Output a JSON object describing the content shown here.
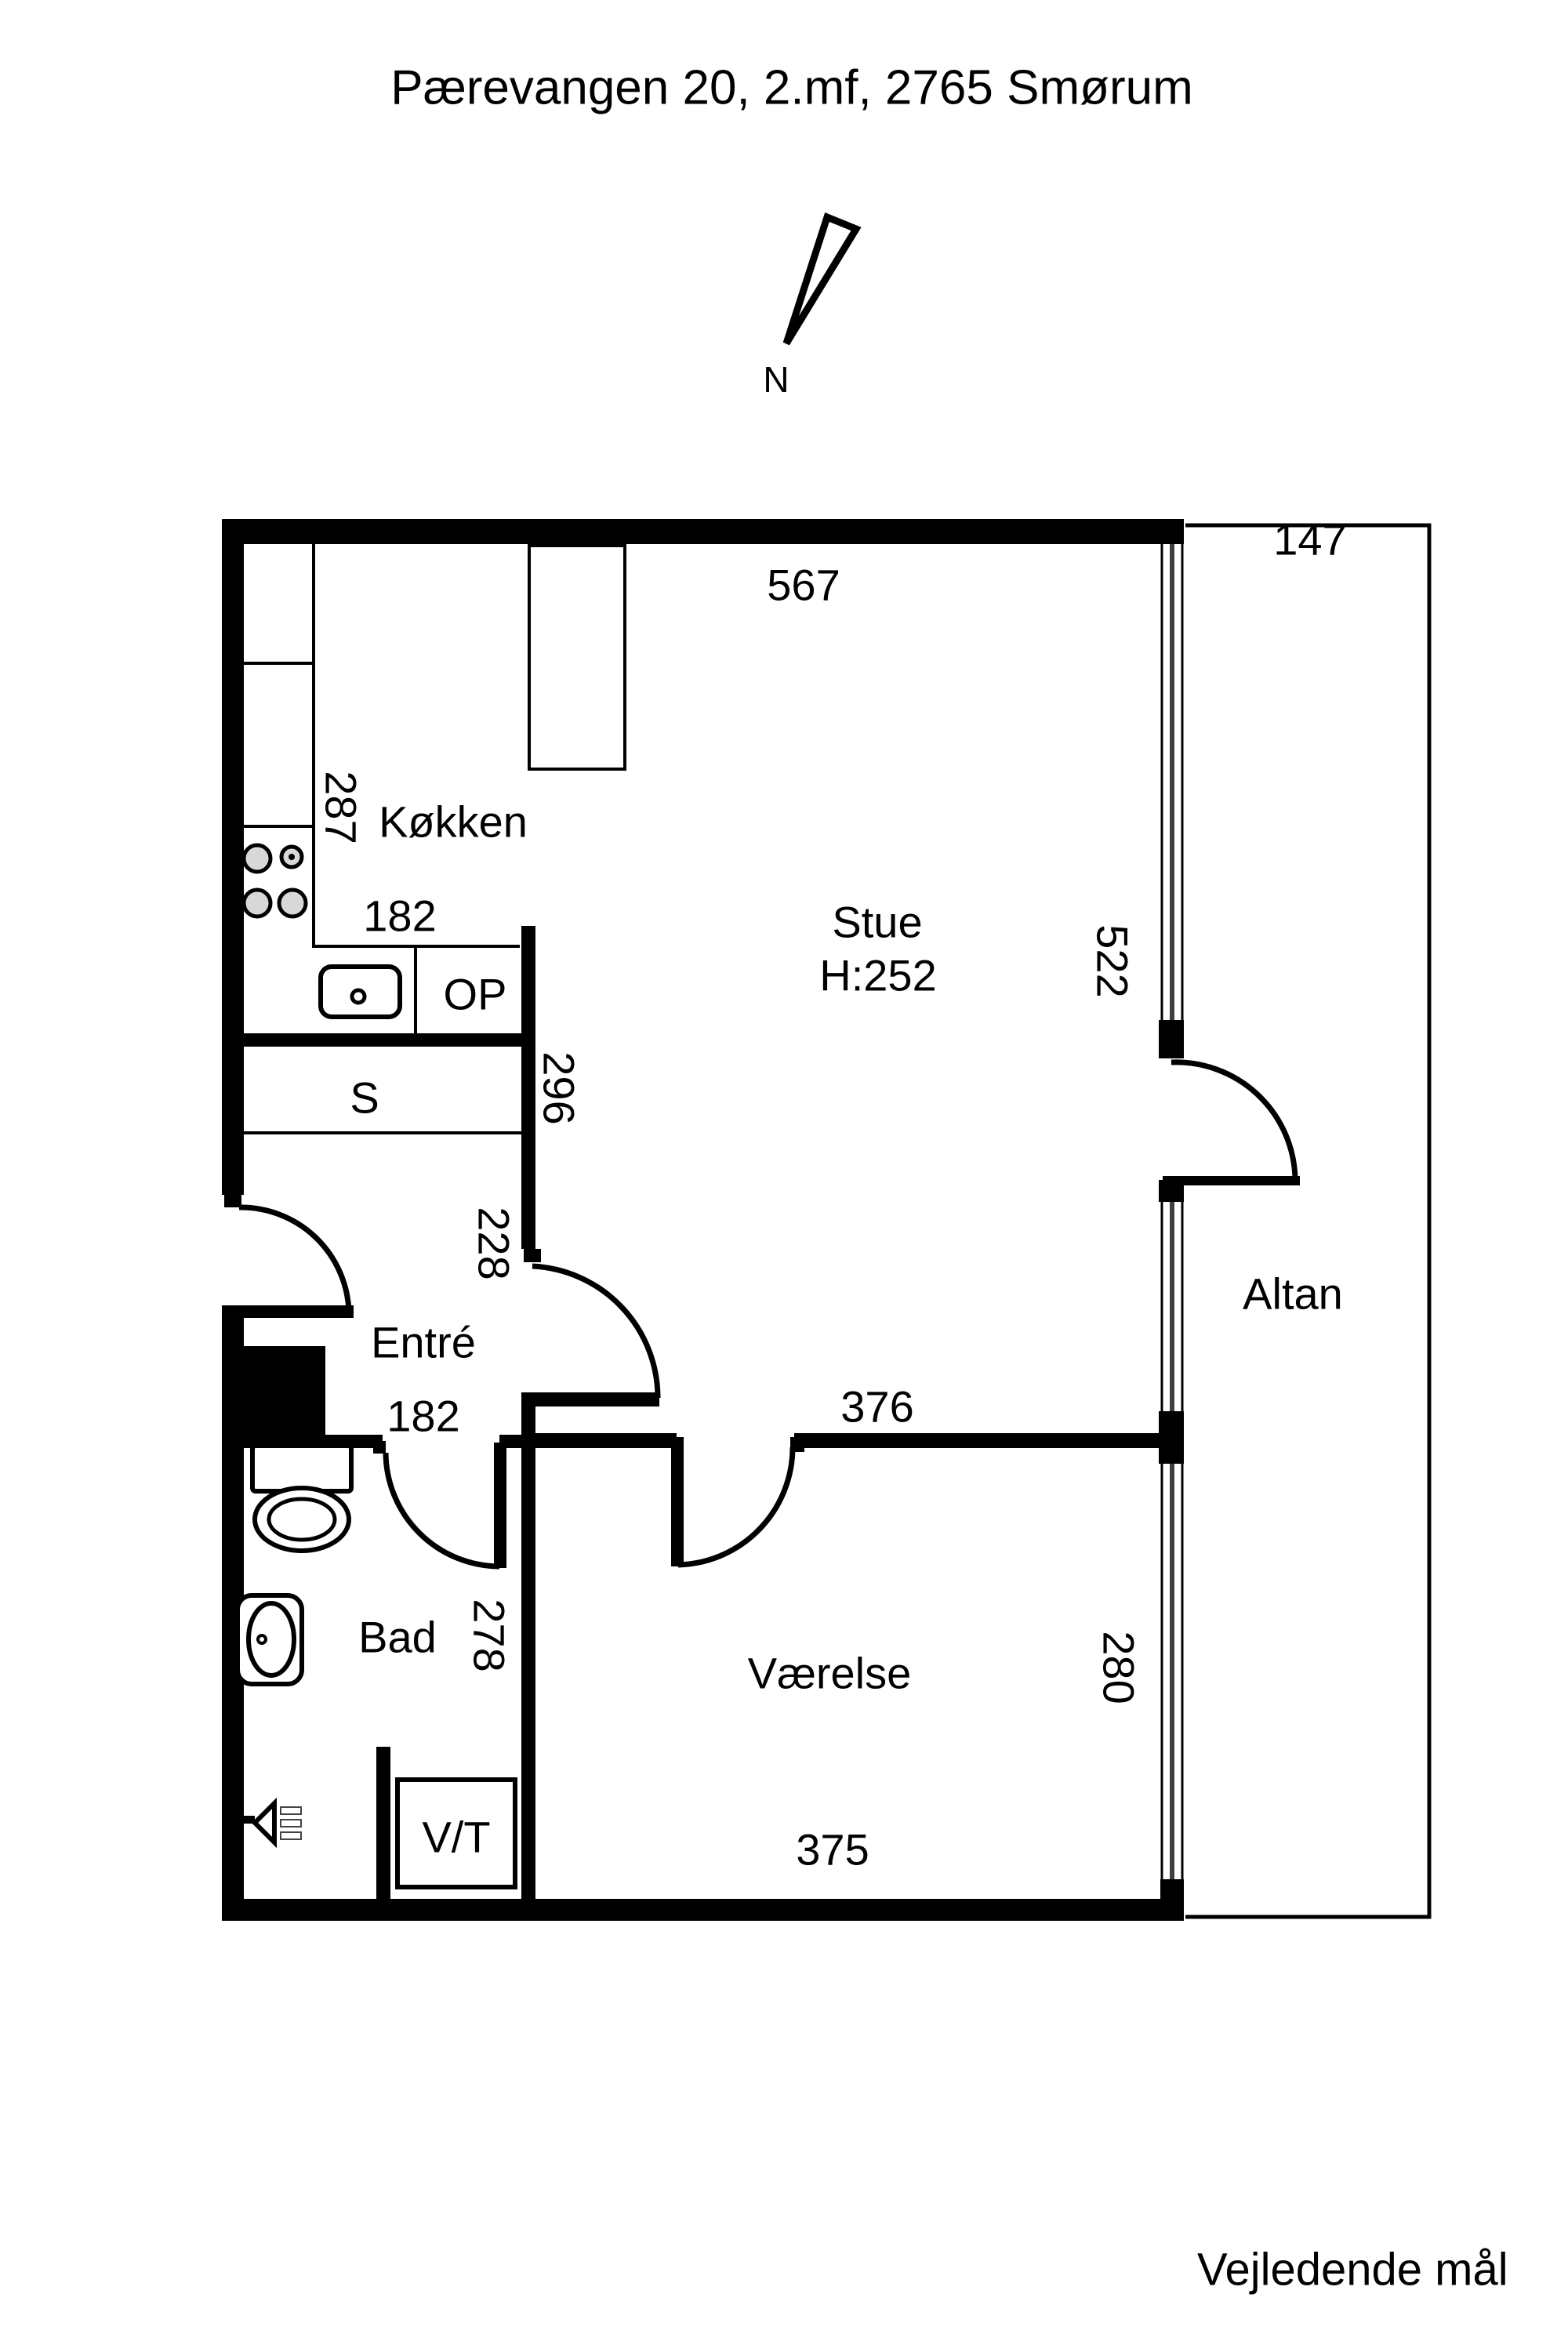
{
  "header": {
    "title": "Pærevangen 20, 2.mf, 2765 Smørum"
  },
  "footer": {
    "note": "Vejledende mål"
  },
  "compass": {
    "label": "N"
  },
  "rooms": {
    "kokken": {
      "name": "Køkken"
    },
    "stue": {
      "name": "Stue",
      "ceiling_height": "H:252"
    },
    "entre": {
      "name": "Entré"
    },
    "bad": {
      "name": "Bad"
    },
    "vaerelse": {
      "name": "Værelse"
    },
    "altan": {
      "name": "Altan"
    },
    "closet": {
      "name": "S"
    },
    "op": {
      "name": "OP"
    },
    "vt": {
      "name": "V/T"
    }
  },
  "dimensions": {
    "top_width": "567",
    "balcony_width": "147",
    "kitchen_depth": "287",
    "kitchen_width": "182",
    "s_depth": "296",
    "stue_height": "522",
    "entre_depth": "228",
    "corridor_width": "182",
    "vaerelse_top_width": "376",
    "vaerelse_height": "280",
    "bad_depth": "278",
    "vaerelse_bottom_width": "375"
  },
  "colors": {
    "wall": "#000000",
    "background": "#ffffff",
    "window_glass_line": "#3c4043",
    "burner_fill": "#d8d8d8"
  }
}
